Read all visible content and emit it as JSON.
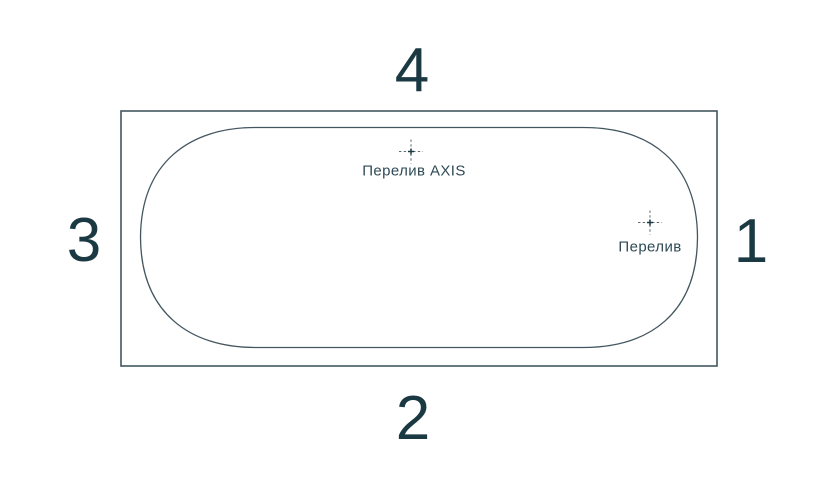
{
  "diagram": {
    "side_numbers": {
      "top": "4",
      "right": "1",
      "bottom": "2",
      "left": "3"
    },
    "overflow_axis_label": "Перелив AXIS",
    "overflow_label": "Перелив",
    "colors": {
      "background": "#ffffff",
      "line": "#43565f",
      "number": "#1b3942",
      "label": "#2e4a55",
      "mark": "#5a6b73"
    }
  }
}
